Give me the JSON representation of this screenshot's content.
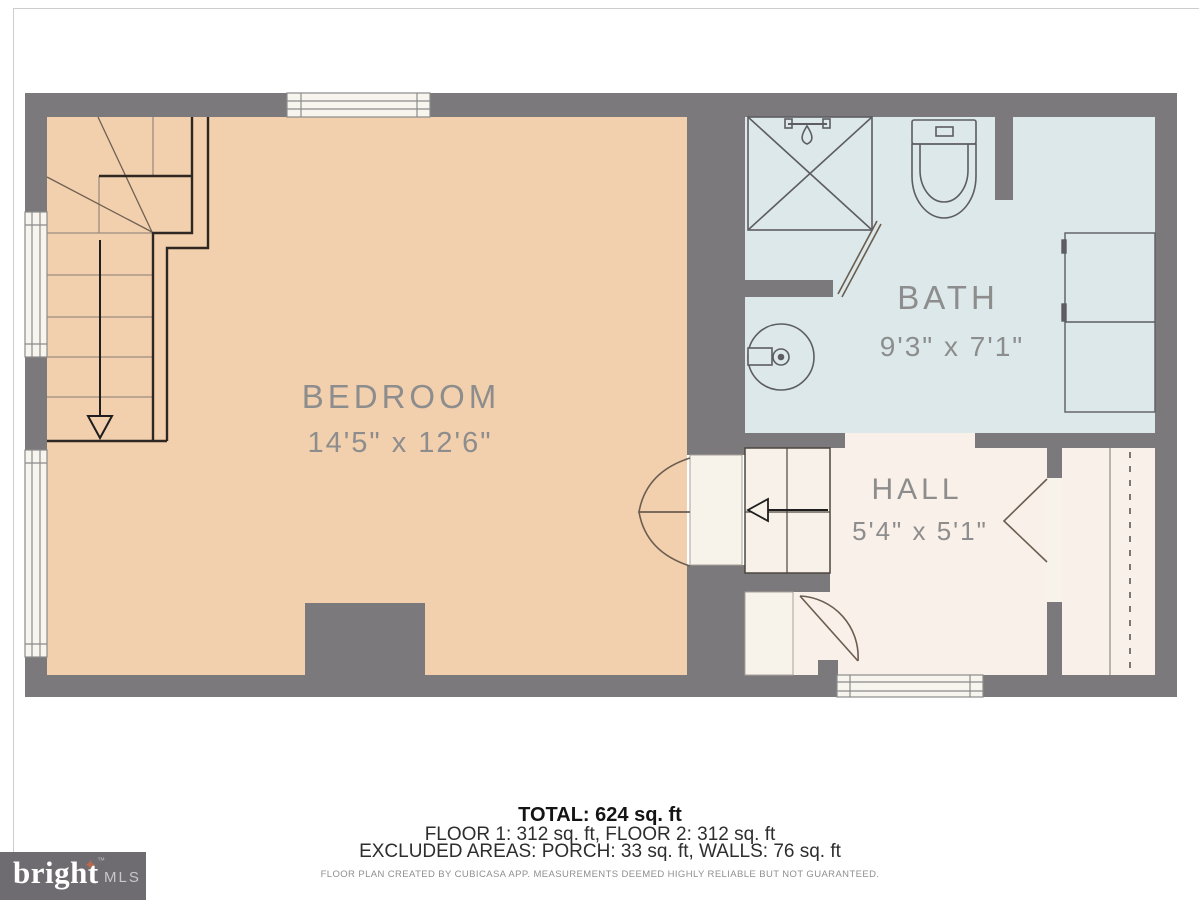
{
  "rooms": [
    {
      "name": "BEDROOM",
      "dimensions": "14'5\" x 12'6\""
    },
    {
      "name": "BATH",
      "dimensions": "9'3\" x 7'1\""
    },
    {
      "name": "HALL",
      "dimensions": "5'4\" x 5'1\""
    }
  ],
  "footer": {
    "total": "TOTAL: 624 sq. ft",
    "floors": "FLOOR 1: 312 sq. ft, FLOOR 2: 312 sq. ft",
    "excluded": "EXCLUDED AREAS: PORCH: 33 sq. ft, WALLS: 76 sq. ft",
    "disclaimer": "FLOOR PLAN CREATED BY CUBICASA APP. MEASUREMENTS DEEMED HIGHLY RELIABLE BUT NOT GUARANTEED."
  },
  "logo": {
    "brand": "bright",
    "trademark": "™",
    "suffix": "MLS",
    "star": "✦"
  },
  "colors": {
    "wall": "#7b797c",
    "bedroom_fill": "#f2d0ae",
    "bath_fill": "#dce8e9",
    "hall_fill": "#f9f0e9",
    "door_panel": "#f7f2ea",
    "accent_star": "#b96a4d",
    "label_gray": "#8d8d8d"
  }
}
